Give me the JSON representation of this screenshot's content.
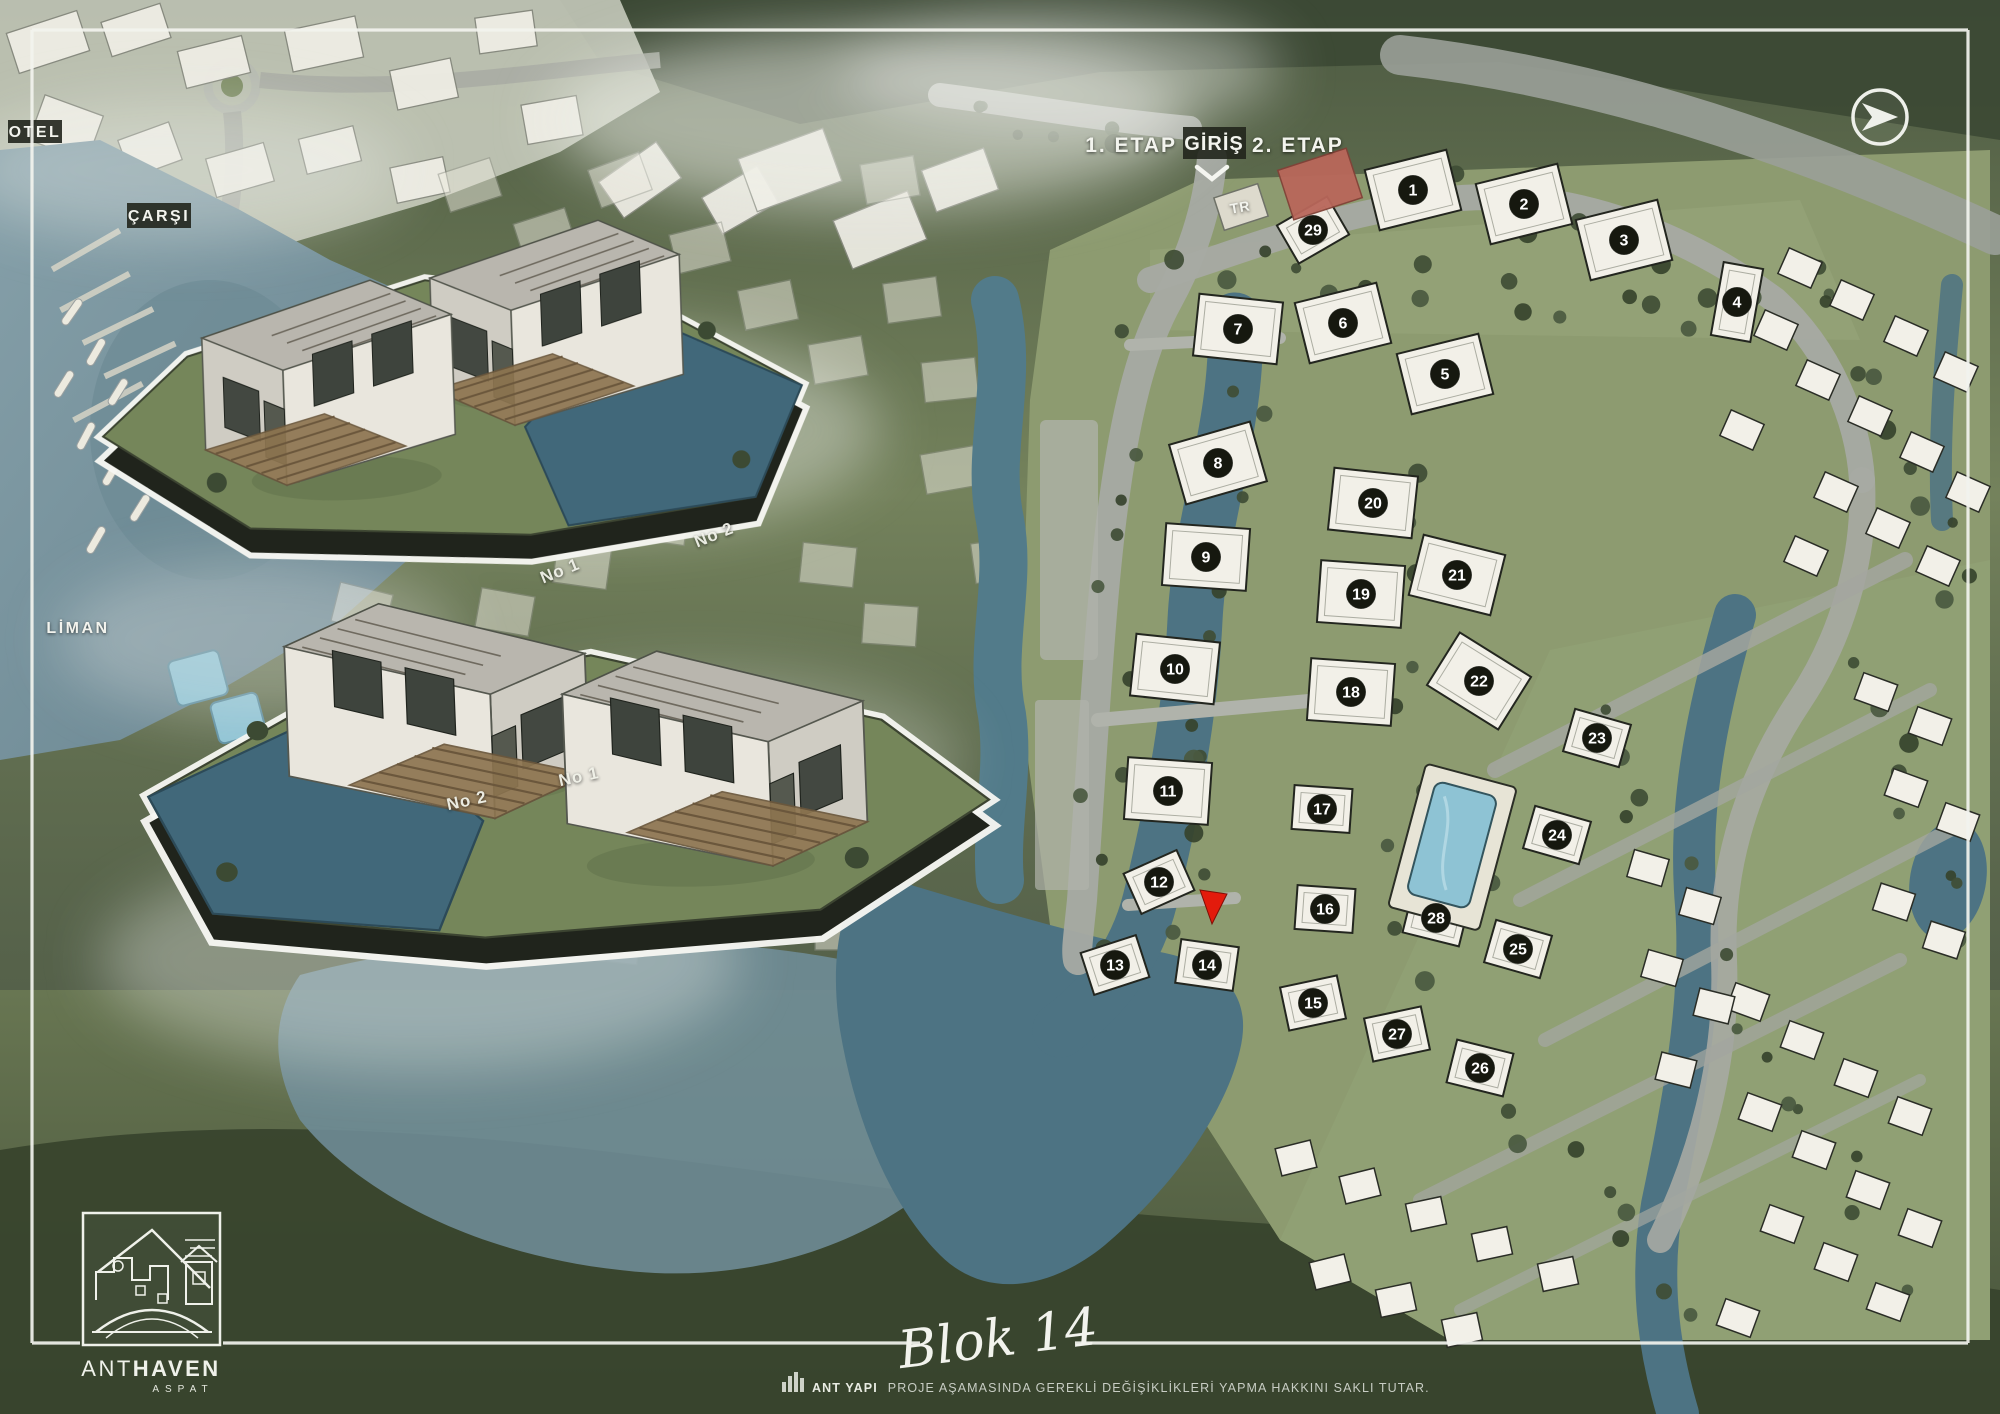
{
  "header": {
    "phase1": "1. ETAP",
    "entrance": "GİRİŞ",
    "phase2": "2. ETAP"
  },
  "area_labels": {
    "otel": "OTEL",
    "carsi": "ÇARŞI",
    "liman": "LİMAN",
    "transformer": "TR"
  },
  "blocks": [
    {
      "n": "1",
      "x": 1413,
      "y": 190,
      "r": -14,
      "s": "L"
    },
    {
      "n": "2",
      "x": 1524,
      "y": 204,
      "r": -14,
      "s": "L"
    },
    {
      "n": "3",
      "x": 1624,
      "y": 240,
      "r": -14,
      "s": "L"
    },
    {
      "n": "4",
      "x": 1737,
      "y": 302,
      "r": 10,
      "s": "T"
    },
    {
      "n": "5",
      "x": 1445,
      "y": 374,
      "r": -14,
      "s": "L"
    },
    {
      "n": "6",
      "x": 1343,
      "y": 323,
      "r": -14,
      "s": "L"
    },
    {
      "n": "7",
      "x": 1238,
      "y": 329,
      "r": 6,
      "s": "L"
    },
    {
      "n": "8",
      "x": 1218,
      "y": 463,
      "r": -16,
      "s": "L"
    },
    {
      "n": "9",
      "x": 1206,
      "y": 557,
      "r": 4,
      "s": "L"
    },
    {
      "n": "10",
      "x": 1175,
      "y": 669,
      "r": 6,
      "s": "L"
    },
    {
      "n": "11",
      "x": 1168,
      "y": 791,
      "r": 4,
      "s": "L"
    },
    {
      "n": "12",
      "x": 1159,
      "y": 882,
      "r": -24,
      "s": "M"
    },
    {
      "n": "13",
      "x": 1115,
      "y": 965,
      "r": -18,
      "s": "M"
    },
    {
      "n": "14",
      "x": 1207,
      "y": 965,
      "r": 8,
      "s": "M"
    },
    {
      "n": "15",
      "x": 1313,
      "y": 1003,
      "r": -12,
      "s": "M"
    },
    {
      "n": "16",
      "x": 1325,
      "y": 909,
      "r": 4,
      "s": "M"
    },
    {
      "n": "17",
      "x": 1322,
      "y": 809,
      "r": 4,
      "s": "M"
    },
    {
      "n": "18",
      "x": 1351,
      "y": 692,
      "r": 4,
      "s": "L"
    },
    {
      "n": "19",
      "x": 1361,
      "y": 594,
      "r": 4,
      "s": "L"
    },
    {
      "n": "20",
      "x": 1373,
      "y": 503,
      "r": 6,
      "s": "L"
    },
    {
      "n": "21",
      "x": 1457,
      "y": 575,
      "r": 14,
      "s": "L"
    },
    {
      "n": "22",
      "x": 1479,
      "y": 681,
      "r": 32,
      "s": "L"
    },
    {
      "n": "23",
      "x": 1597,
      "y": 738,
      "r": 16,
      "s": "M"
    },
    {
      "n": "24",
      "x": 1557,
      "y": 835,
      "r": 16,
      "s": "M"
    },
    {
      "n": "25",
      "x": 1518,
      "y": 949,
      "r": 16,
      "s": "M"
    },
    {
      "n": "26",
      "x": 1480,
      "y": 1068,
      "r": 14,
      "s": "M"
    },
    {
      "n": "27",
      "x": 1397,
      "y": 1034,
      "r": -12,
      "s": "M"
    },
    {
      "n": "28",
      "x": 1436,
      "y": 918,
      "r": 14,
      "s": "M"
    },
    {
      "n": "29",
      "x": 1313,
      "y": 230,
      "r": -30,
      "s": "M"
    }
  ],
  "selected_marker": {
    "block": "14",
    "x": 1213,
    "y": 906
  },
  "unit_labels": {
    "top": [
      {
        "text": "No 1",
        "x": 562,
        "y": 576,
        "rot": -22
      },
      {
        "text": "No 2",
        "x": 716,
        "y": 540,
        "rot": -22
      }
    ],
    "bottom": [
      {
        "text": "No 2",
        "x": 468,
        "y": 806,
        "rot": -12
      },
      {
        "text": "No 1",
        "x": 580,
        "y": 782,
        "rot": -12
      }
    ]
  },
  "footer": {
    "title": "Blok 14",
    "brand": "ANT YAPI",
    "disclaimer": "PROJE AŞAMASINDA GEREKLİ DEĞİŞİKLİKLERİ YAPMA HAKKINI SAKLI TUTAR."
  },
  "logo": {
    "brand_thin": "ANT",
    "brand_bold": "HAVEN",
    "subtitle": "ASPAT"
  },
  "colors": {
    "marker_circle": "#16180f",
    "marker_text": "#ffffff",
    "selected_red": "#e31b0c",
    "water": "#4d7383",
    "site_green": "#8d9b70",
    "building_fill": "#f2f0e8"
  }
}
